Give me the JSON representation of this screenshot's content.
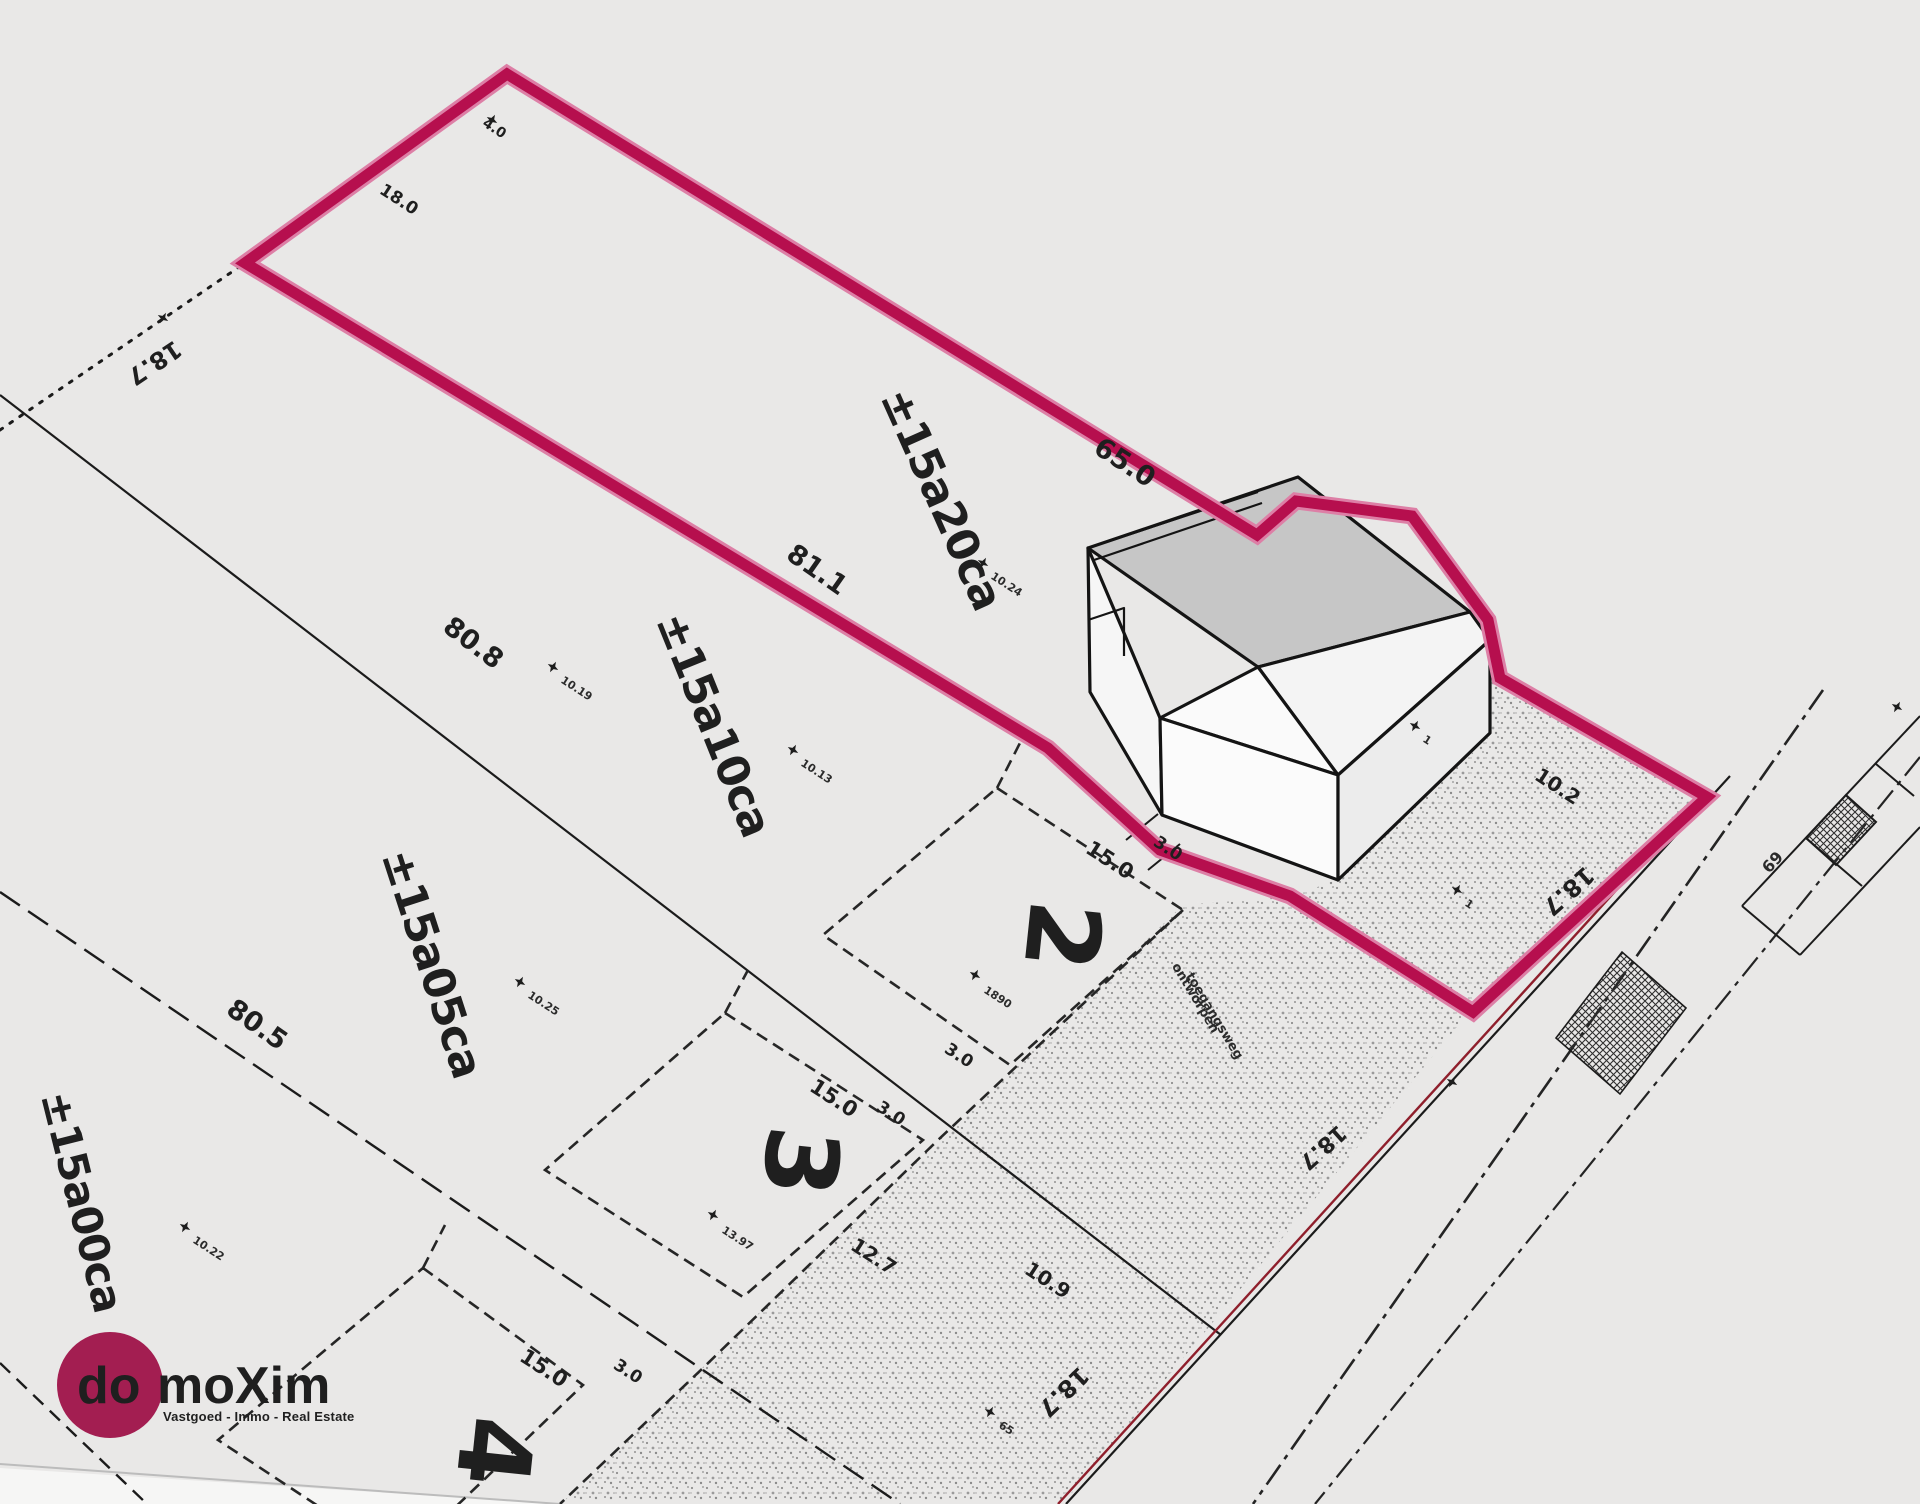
{
  "brand": {
    "logo_prefix": "do",
    "logo_suffix": "moXim",
    "tagline": "Vastgoed - Immo - Real Estate",
    "brand_color": "#a31e51",
    "highlight_color": "#b60f4e"
  },
  "plots": {
    "plot1_area": "±15a20ca",
    "plot2_area": "±15a10ca",
    "plot2_number": "2",
    "plot3_area": "±15a05ca",
    "plot3_number": "3",
    "plot4_area": "±15a00ca",
    "plot4_number": "4"
  },
  "dims": {
    "depth1": "65.0",
    "depth2": "81.1",
    "depth3": "80.8",
    "depth4": "80.5",
    "frontage": "18.7",
    "envelope_width": "15.0",
    "side_gap": "3.0",
    "d102": "10.2",
    "d109": "10.9",
    "d127": "12.7",
    "d180": "18.0",
    "d40": "4.0"
  },
  "notes": {
    "driveway_line1": "ontworpen",
    "driveway_line2": "toegangsweg"
  },
  "markers": {
    "m1019": "10.19",
    "m1013": "10.13",
    "m1024": "10.24",
    "m1025": "10.25",
    "m1022": "10.22",
    "m1890": "1890",
    "m1397": "13.97",
    "m65": "65",
    "m69": "69",
    "m1": "1"
  }
}
